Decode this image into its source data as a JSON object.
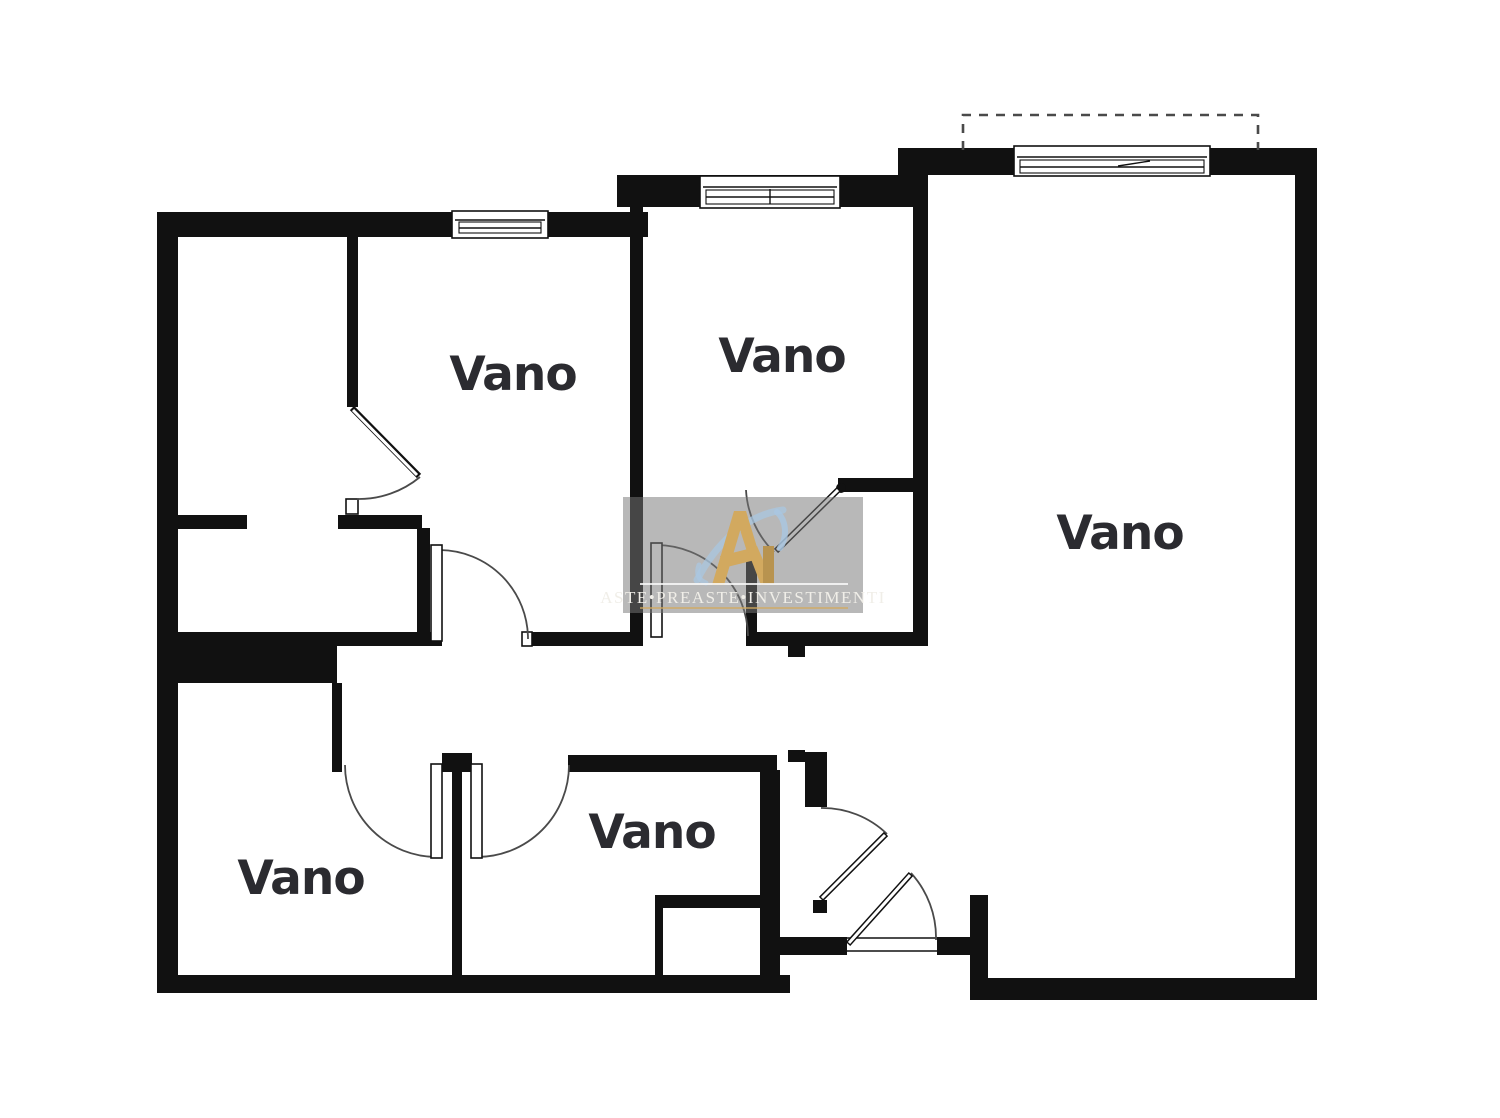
{
  "rooms": [
    {
      "label": "Vano"
    },
    {
      "label": "Vano"
    },
    {
      "label": "Vano"
    },
    {
      "label": "Vano"
    },
    {
      "label": "Vano"
    }
  ],
  "watermark": {
    "text": "ASTE•PREASTE•INVESTIMENTI",
    "logo_icon": "gold-peak-monogram-with-blue-swirl"
  },
  "colors": {
    "wall": "#111111",
    "room_label": "#2b2b30",
    "door_arc": "#4a4a4a",
    "dashed_outline": "#4a4a4a",
    "watermark_overlay": "rgba(118,118,118,0.52)",
    "watermark_text": "#f0eee8",
    "watermark_rule": "rgba(248,248,248,0.85)",
    "gold": "#d2a95f",
    "gold_dark": "#b8934f",
    "blue_swirl": "#a9c7e2"
  }
}
